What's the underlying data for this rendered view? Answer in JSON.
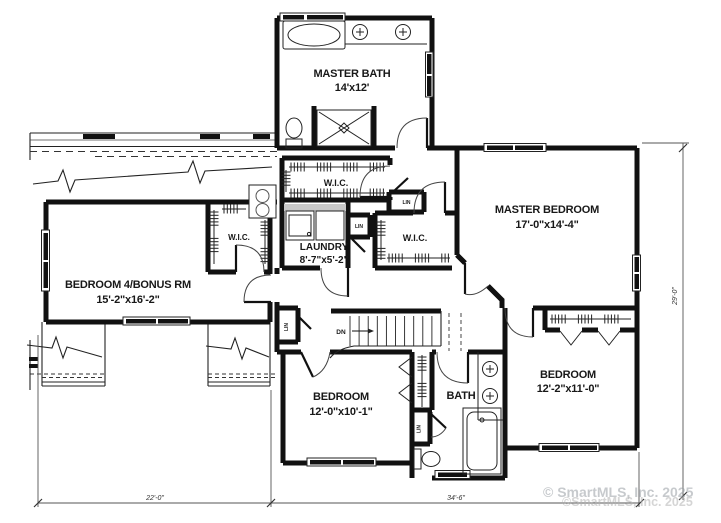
{
  "rooms": {
    "master_bath": {
      "name": "MASTER BATH",
      "dims": "14'x12'"
    },
    "master_bedroom": {
      "name": "MASTER BEDROOM",
      "dims": "17'-0\"x14'-4\""
    },
    "bedroom4": {
      "name": "BEDROOM 4/BONUS RM",
      "dims": "15'-2\"x16'-2\""
    },
    "laundry": {
      "name": "LAUNDRY",
      "dims": "8'-7\"x5'-2\""
    },
    "bedroom2": {
      "name": "BEDROOM",
      "dims": "12'-0\"x10'-1\""
    },
    "bedroom3": {
      "name": "BEDROOM",
      "dims": "12'-2\"x11'-0\""
    },
    "bath": {
      "name": "BATH"
    },
    "wic": {
      "name": "W.I.C."
    },
    "linen": {
      "name": "LIN"
    },
    "stairs": {
      "label": "DN"
    }
  },
  "dimensions": {
    "bottom_left": "22'-0\"",
    "bottom_right": "34'-6\"",
    "right_side": "29'-0\""
  },
  "watermark": {
    "line1": "© SmartMLS, Inc. 2025",
    "line2": "©SmartMLS, Inc. 2025"
  }
}
